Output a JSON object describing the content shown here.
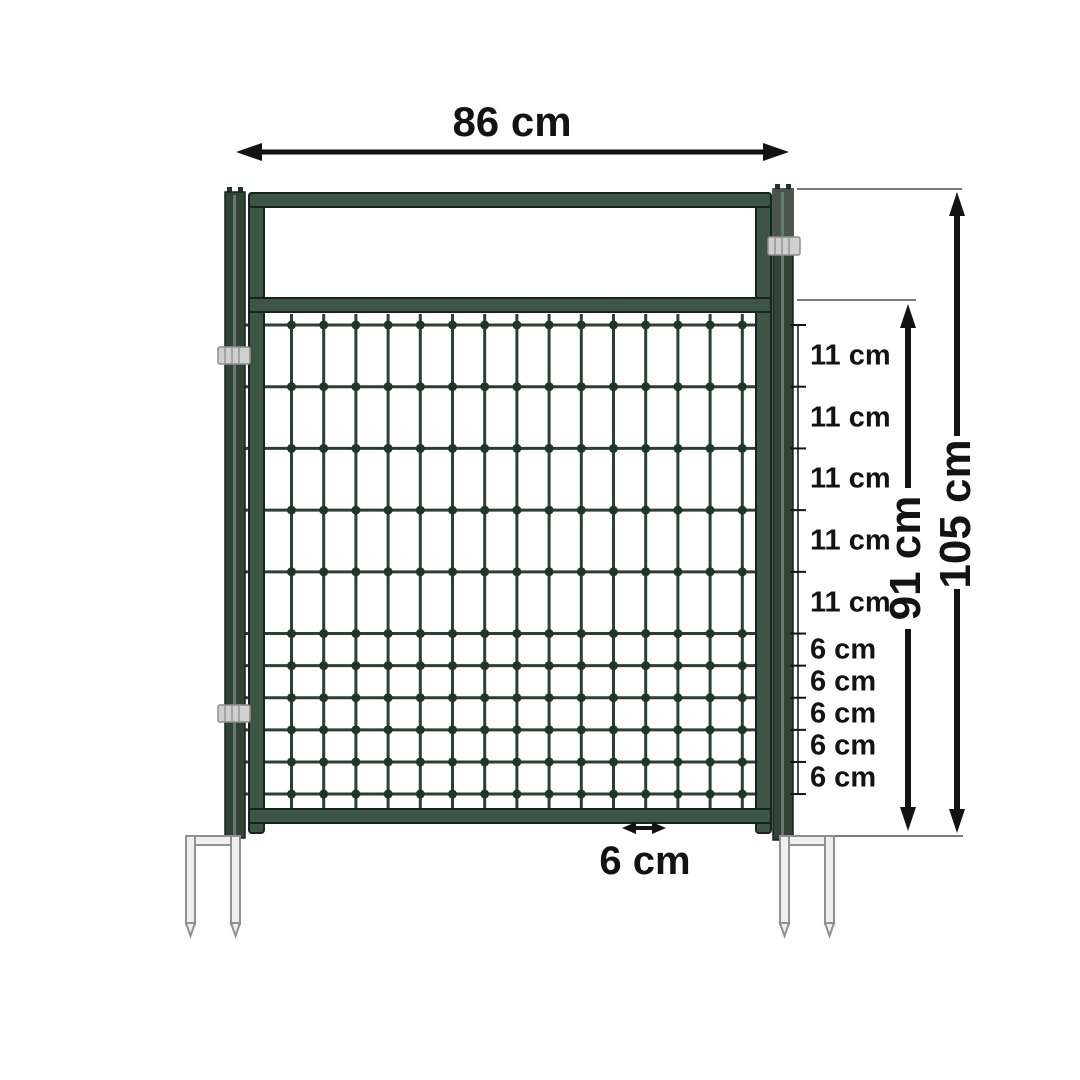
{
  "labels": {
    "width": "86 cm",
    "total_height": "105 cm",
    "mesh_height": "91 cm",
    "mesh_column_spacing": "6 cm",
    "row_spacings": [
      "11 cm",
      "11 cm",
      "11 cm",
      "11 cm",
      "11 cm",
      "6 cm",
      "6 cm",
      "6 cm",
      "6 cm",
      "6 cm"
    ]
  },
  "measurements": {
    "width_cm": 86,
    "total_height_cm": 105,
    "mesh_height_cm": 91,
    "row_gaps_cm": [
      11,
      11,
      11,
      11,
      11,
      6,
      6,
      6,
      6,
      6
    ],
    "column_gap_cm": 6
  },
  "colors": {
    "background": "#ffffff",
    "frame_green": "#3c5547",
    "frame_outline": "#15251b",
    "wire_green": "#2a4034",
    "dot_green": "#223529",
    "post_highlight": "#6b8273",
    "post_top_gray": "#49544d",
    "clamp_gray": "#cfcfcf",
    "clamp_edge": "#8e8e8e",
    "stake_fill": "#efefef",
    "stake_edge": "#909090",
    "dimension_ink": "#131313",
    "extension_gray": "#7a7a7a"
  }
}
